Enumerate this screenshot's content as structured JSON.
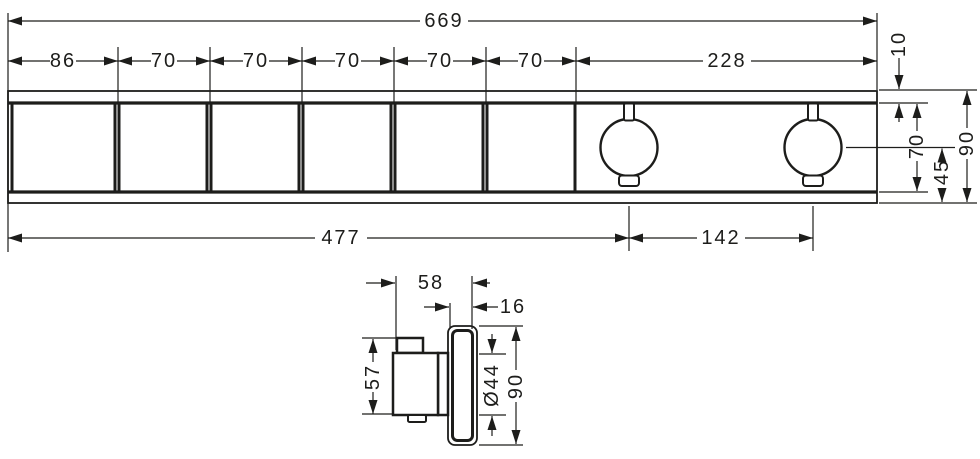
{
  "title": "Technical dimension drawing - concealed shower valve trim",
  "units": "mm",
  "line_color": "#1d1d1b",
  "background_color": "#ffffff",
  "front": {
    "width_total": "669",
    "segments": [
      "86",
      "70",
      "70",
      "70",
      "70",
      "70",
      "228"
    ],
    "offset_top": "10",
    "inner_height": "70",
    "half_height": "45",
    "height_total": "90",
    "left_to_knob1_center": "477",
    "knob_center_spacing": "142"
  },
  "side": {
    "wall_to_handle_front": "58",
    "plate_thickness": "16",
    "handle_height": "57",
    "handle_diameter": "Ø44",
    "height_total": "90"
  }
}
